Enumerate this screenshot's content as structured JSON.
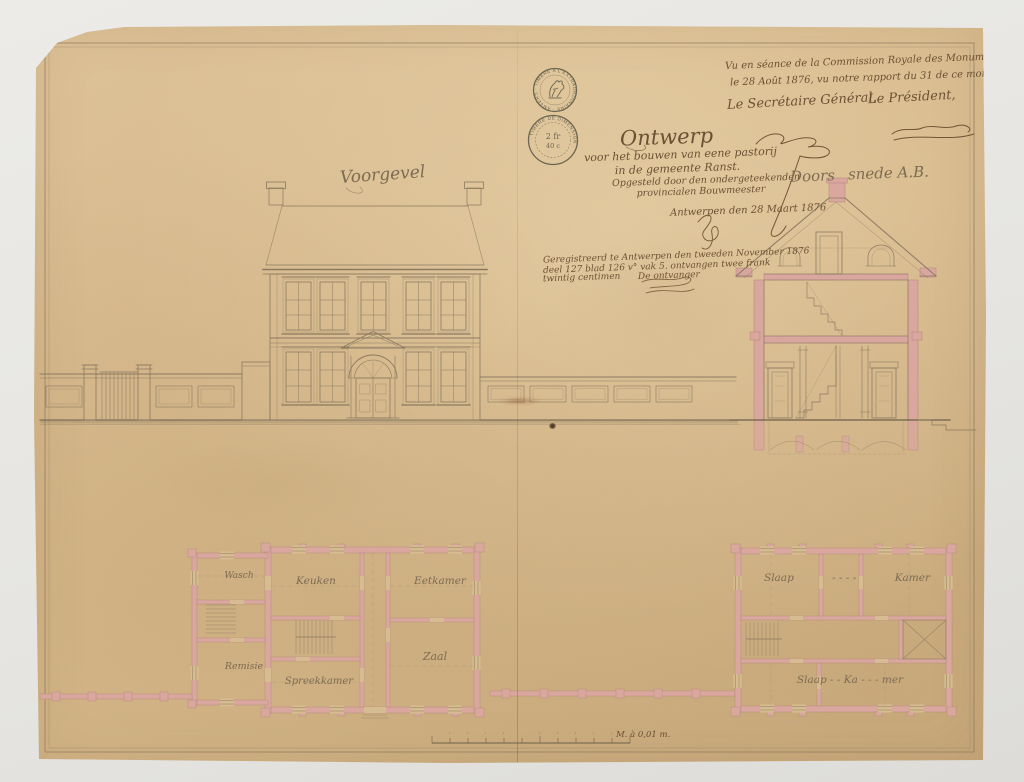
{
  "approval": {
    "line1": "Vu en séance de la Commission Royale des Monuments,",
    "line2": "le 28 Août 1876, vu notre rapport du 31 de ce mois, N° 4729.",
    "secretary_label": "Le Secrétaire Général,",
    "president_label": "Le Président,"
  },
  "title_block": {
    "title": "Ontwerp",
    "subtitle1": "voor het bouwen van eene pastorij",
    "subtitle2": "in de gemeente Ranst.",
    "subtitle3": "Opgesteld door den ondergeteekenden",
    "subtitle4": "provincialen Bouwmeester",
    "date_line": "Antwerpen den 28 Maart 1876"
  },
  "registration": {
    "line1": "Geregistreerd te Antwerpen den tweeden November 1876",
    "line2": "deel 127 blad 126 v° vak 5. ontvangen twee frank",
    "line3": "twintig centimen",
    "signoff": "De ontvanger"
  },
  "drawing_labels": {
    "elevation": "Voorgevel",
    "section_part1": "Doors",
    "section_part2": "snede A.B."
  },
  "stamps": {
    "tax_stamp": {
      "ring_text": "· TIMBRE A L'EXTRAORDINAIRE · ANVERS ·"
    },
    "dimension_stamp": {
      "ring_text": "· TIMBRE DE DIMENSION ·",
      "value_top": "2 fr",
      "value_bottom": "40 c"
    }
  },
  "ground_floor_plan": {
    "rooms": {
      "r1": "Wasch",
      "r2": "Keuken",
      "r3": "Eetkamer",
      "r4": "Remisie",
      "r5": "Spreekkamer",
      "r6": "Zaal"
    }
  },
  "upper_floor_plan": {
    "row1_left": "Slaap",
    "row1_dashes": "- - - -",
    "row1_right": "Kamer",
    "row2": "Slaap - -   Ka - - - mer"
  },
  "scale_bar": {
    "label": "M. à 0,01 m."
  },
  "colors": {
    "paper": "#d8bc91",
    "ink": "#8b7a61",
    "wall_pink": "#d9a79e",
    "handwriting": "#6b5134"
  }
}
